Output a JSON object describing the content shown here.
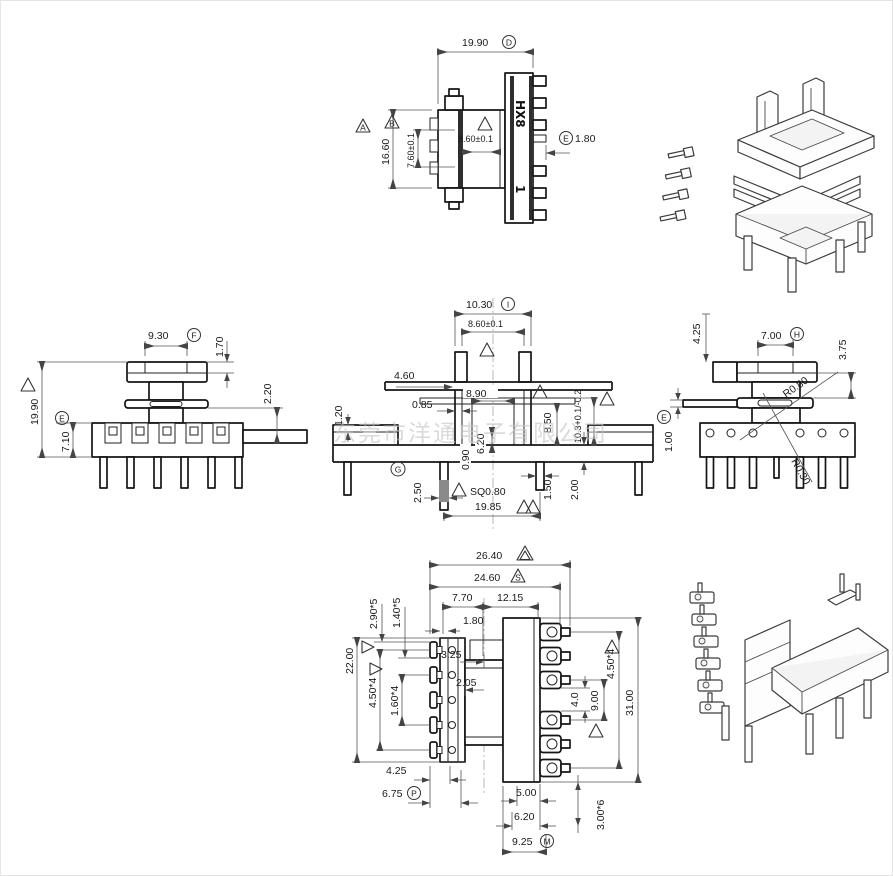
{
  "watermark": "东莞市洋通电子有限公司",
  "part": {
    "marking": "HX8",
    "pin1_mark": "1"
  },
  "symbols": {
    "flagA": "A",
    "flagB": "B",
    "flagS": "S",
    "tagD": "D",
    "tagE": "E",
    "tagF": "F",
    "tagG": "G",
    "tagH": "H",
    "tagI": "I",
    "tagM": "M",
    "tagP": "P"
  },
  "top_view": {
    "overall_w": "19.90",
    "overall_h": "16.60",
    "window_w": "7.60±0.1",
    "core_w": "8.60±0.1",
    "pin_step": "1.80"
  },
  "left_view": {
    "flange_w": "9.30",
    "flange_t": "1.70",
    "total_h": "19.90",
    "base_h": "7.10",
    "ledge": "2.20"
  },
  "front_view": {
    "top_w": "10.30",
    "core_w": "8.60±0.1",
    "d_4_60": "4.60",
    "d_8_90": "8.90",
    "d_0_85": "0.85",
    "d_8_50": "8.50",
    "tol_10_3": "10.3+0.1/-0.2",
    "d_1_20": "1.20",
    "d_0_90": "0.90",
    "d_6_20": "6.20",
    "d_2_50": "2.50",
    "sq": "SQ0.80",
    "pin_span": "19.85",
    "d_1_50": "1.50",
    "d_2_00": "2.00"
  },
  "right_view": {
    "d_4_25": "4.25",
    "d_7_00": "7.00",
    "d_3_75": "3.75",
    "r1": "R0.80",
    "r2": "R0.30",
    "d_1_00": "1.00"
  },
  "bottom_view": {
    "overall_w": "26.40",
    "body_w": "24.60",
    "d_7_70": "7.70",
    "d_12_15": "12.15",
    "d_1_80": "1.80",
    "pitch_2_90": "2.90*5",
    "pitch_1_40": "1.40*5",
    "height": "22.00",
    "pitch_4_50_l": "4.50*4",
    "pitch_1_60": "1.60*4",
    "d_3_25": "3.25",
    "d_2_05": "2.05",
    "d_4_0": "4.0",
    "d_9_00": "9.00",
    "overall_h": "31.00",
    "pitch_4_50_r": "4.50*4",
    "d_4_25": "4.25",
    "d_6_75": "6.75",
    "d_5_00": "5.00",
    "d_6_20": "6.20",
    "d_9_25": "9.25",
    "pitch_3_00": "3.00*6"
  }
}
